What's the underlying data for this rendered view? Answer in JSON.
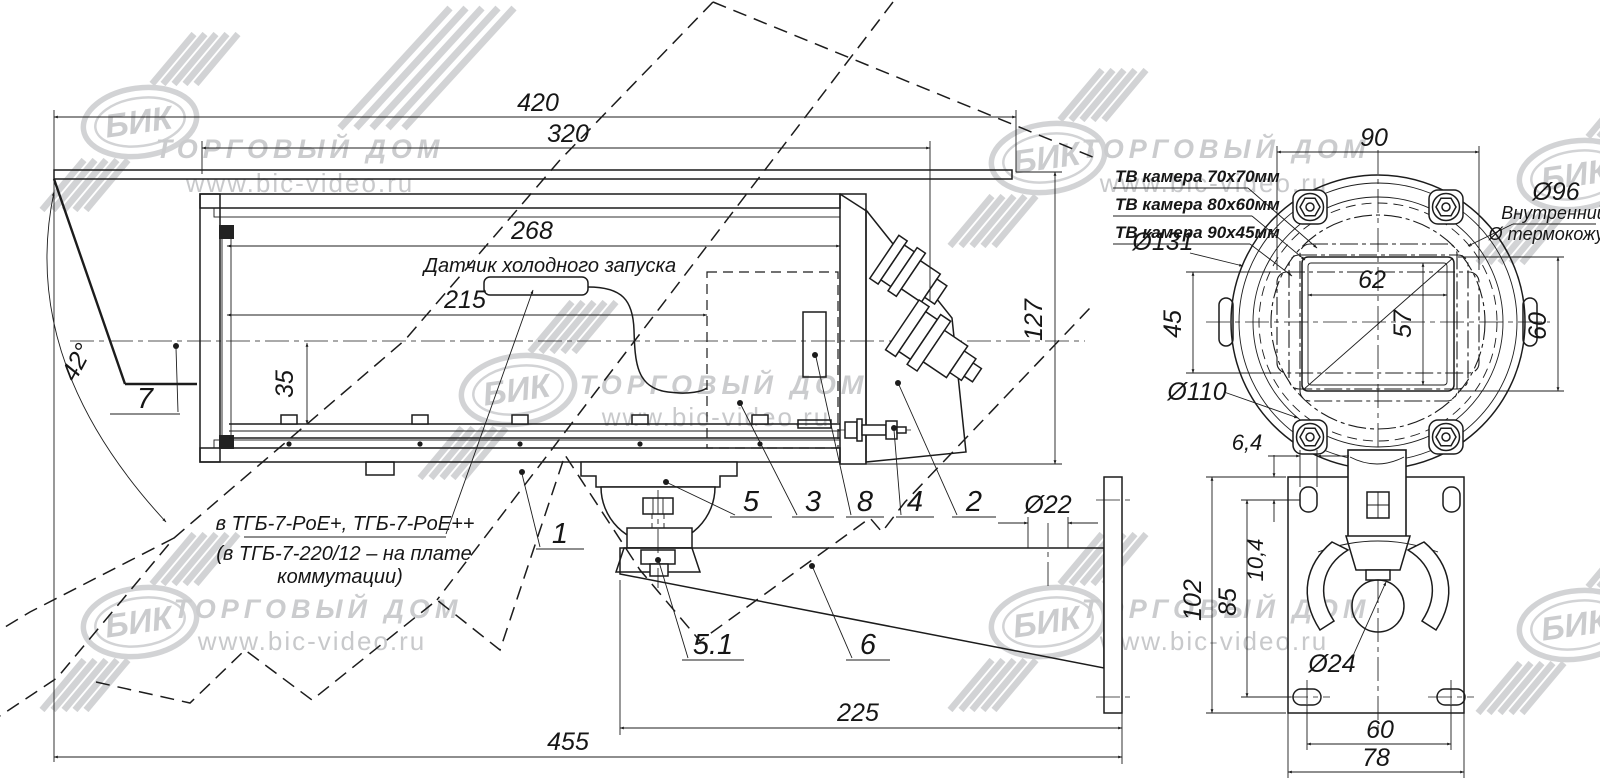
{
  "watermark": {
    "logo_text": "БИК",
    "company": "ТОРГОВЫЙ ДОМ",
    "website": "www.bic-video.ru"
  },
  "side_view": {
    "dim_overall_length": "420",
    "dim_body_length": "320",
    "dim_inner_length": "268",
    "dim_sensor_length": "215",
    "dim_rail_offset": "35",
    "dim_height": "127",
    "dim_visor_angle": "42°",
    "dim_arm_hole": "Ø22",
    "dim_arm_length": "225",
    "dim_total_length": "455",
    "sensor_label": "Датчик холодного запуска",
    "note_line1": "в ТГБ-7-PoE+, ТГБ-7-PoE++",
    "note_line2": "(в ТГБ-7-220/12 – на плате",
    "note_line3": "коммутации)",
    "callout_7": "7",
    "callout_1": "1",
    "callout_5": "5",
    "callout_3": "3",
    "callout_8": "8",
    "callout_4": "4",
    "callout_2": "2",
    "callout_5_1": "5.1",
    "callout_6": "6"
  },
  "front_view": {
    "dim_top_width": "90",
    "camera_option_1": "ТВ камера 70х70мм",
    "camera_option_2": "ТВ камера 80х60мм",
    "camera_option_3": "ТВ камера 90х45мм",
    "dim_outer_diameter": "Ø131",
    "dim_inner_diameter": "Ø96",
    "inner_note_1": "Внутренний",
    "inner_note_2": "Ø термокожуха",
    "dim_window_width": "62",
    "dim_window_inner_height": "57",
    "dim_left_height": "45",
    "dim_window_height": "60",
    "dim_ring_diameter": "Ø110",
    "dim_slot_width": "6,4",
    "dim_slot_offset": "10,4",
    "dim_plate_height": "102",
    "dim_slot_span": "85",
    "dim_ball_hole": "Ø24",
    "dim_holes_span": "60",
    "dim_plate_width": "78"
  }
}
